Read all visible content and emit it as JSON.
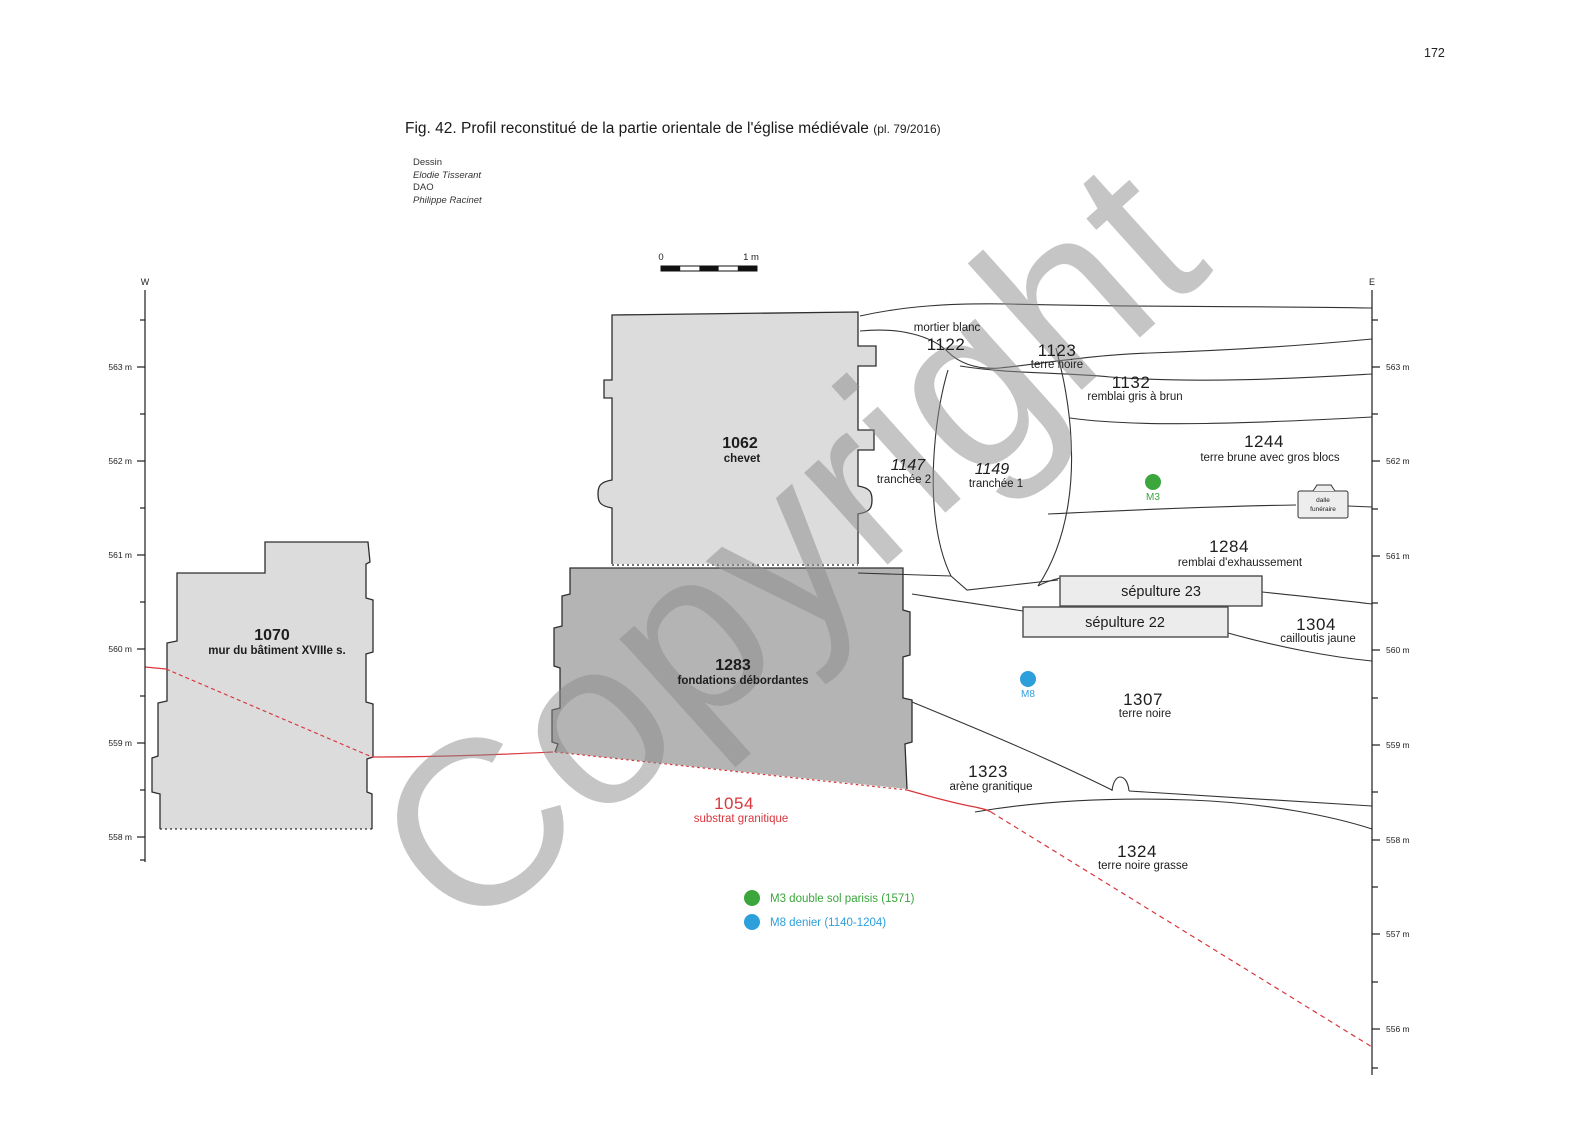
{
  "page": {
    "number": "172"
  },
  "figure": {
    "title": "Fig. 42. Profil reconstitué de la partie orientale de l'église médiévale",
    "suffix": "(pl. 79/2016)",
    "credits": {
      "dessin_label": "Dessin",
      "dessin_name": "Elodie Tisserant",
      "dao_label": "DAO",
      "dao_name": "Philippe Racinet"
    }
  },
  "scale_bar": {
    "zero": "0",
    "one": "1 m"
  },
  "axes": {
    "west_label": "W",
    "east_label": "E",
    "left_ticks": [
      "563 m",
      "562 m",
      "561 m",
      "560 m",
      "559 m",
      "558 m"
    ],
    "right_ticks": [
      "563 m",
      "562 m",
      "561 m",
      "560 m",
      "559 m",
      "558 m",
      "557 m",
      "556 m"
    ]
  },
  "strata": {
    "s1122": {
      "num": "1122",
      "desc": "mortier blanc"
    },
    "s1123": {
      "num": "1123",
      "desc": "terre noire"
    },
    "s1132": {
      "num": "1132",
      "desc": "remblai gris à brun"
    },
    "s1244": {
      "num": "1244",
      "desc": "terre brune avec gros blocs"
    },
    "s1062": {
      "num": "1062",
      "desc": "chevet"
    },
    "s1147": {
      "num": "1147",
      "desc": "tranchée 2"
    },
    "s1149": {
      "num": "1149",
      "desc": "tranchée 1"
    },
    "s1284": {
      "num": "1284",
      "desc": "remblai d'exhaussement"
    },
    "s1304": {
      "num": "1304",
      "desc": "cailloutis jaune"
    },
    "s1307": {
      "num": "1307",
      "desc": "terre noire"
    },
    "s1323": {
      "num": "1323",
      "desc": "arène granitique"
    },
    "s1324": {
      "num": "1324",
      "desc": "terre noire grasse"
    },
    "s1054": {
      "num": "1054",
      "desc": "substrat granitique"
    },
    "s1070": {
      "num": "1070",
      "desc": "mur du bâtiment XVIIIe s."
    },
    "s1283": {
      "num": "1283",
      "desc": "fondations débordantes"
    }
  },
  "features": {
    "sepulture23": "sépulture 23",
    "sepulture22": "sépulture 22",
    "dalle_line1": "dalle",
    "dalle_line2": "funéraire",
    "m3": "M3",
    "m8": "M8"
  },
  "legend": {
    "m3": "M3 double sol parisis (1571)",
    "m8": "M8 denier (1140-1204)"
  },
  "watermark": "Copyright",
  "colors": {
    "green": "#3aa63c",
    "blue": "#2d9fdb",
    "red": "#d8373d",
    "block_light": "#dcdcdc",
    "block_dark": "#b4b4b4",
    "line": "#333333"
  }
}
